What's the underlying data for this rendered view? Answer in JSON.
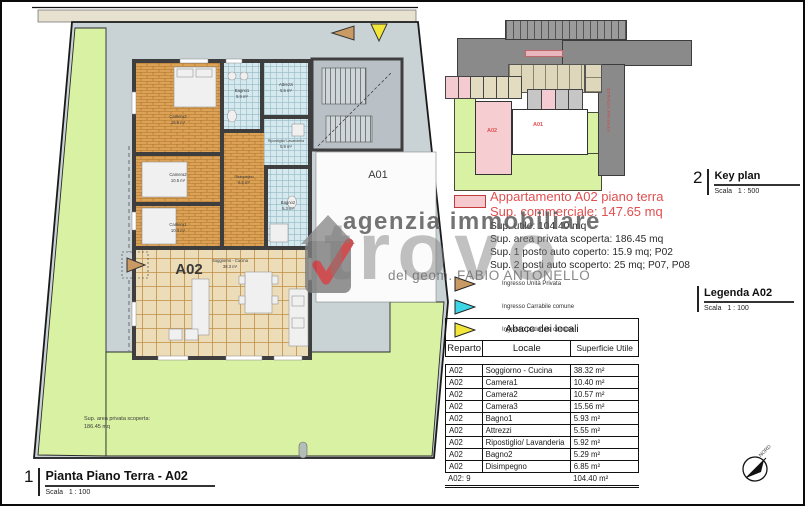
{
  "views": {
    "plan": {
      "number": "1",
      "title": "Pianta Piano Terra - A02",
      "scale": "Scala   1 : 100"
    },
    "keyplan": {
      "number": "2",
      "title": "Key plan",
      "scale": "Scala   1 : 500"
    },
    "legend": {
      "title": "Legenda A02",
      "scale": "Scala   1 : 100"
    }
  },
  "plan": {
    "apartment_label": "A02",
    "neighbor_label": "A01",
    "garden_note": {
      "line1": "Sup. area privata scoperta:",
      "line2": "186.45 mq"
    },
    "rooms": {
      "soggiorno": {
        "name": "Soggiorno - Cucina",
        "area": "38.3 m²"
      },
      "camera1": {
        "name": "Camera1",
        "area": "10.4 m²"
      },
      "camera2": {
        "name": "Camera2",
        "area": "10.5 m²"
      },
      "camera3": {
        "name": "Camera3",
        "area": "15.5 m²"
      },
      "bagno1": {
        "name": "Bagno1",
        "area": "5.9 m²"
      },
      "attrezzi": {
        "name": "Attrezzi",
        "area": "5.5 m²"
      },
      "ripostiglio": {
        "name": "Ripostiglio/ Lavanderia",
        "area": "5.9 m²"
      },
      "bagno2": {
        "name": "Bagno2",
        "area": "5.3 m²"
      },
      "disimpegno": {
        "name": "Disimpegno",
        "area": "6.8 m²"
      }
    }
  },
  "keyplan": {
    "a02_label": "A02",
    "a01_label": "A01",
    "road_label": "STRADA PRIVATA"
  },
  "info": {
    "title": "Appartamento A02 piano terra",
    "subtitle": "Sup. commerciale: 147.65 mq",
    "details": [
      "Sup. utile: 104.40 mq",
      "Sup. area privata scoperta: 186.45 mq",
      "Sup. 1 posto auto coperto: 15.9 mq; P02",
      "Sup. 2 posti auto scoperto: 25 mq; P07, P08"
    ],
    "swatch_color": "#f6c9ce",
    "entrances": [
      {
        "label": "Ingresso Unità Privata",
        "color": "#c99a63"
      },
      {
        "label": "Ingresso Carrabile comune",
        "color": "#3cd6e6"
      },
      {
        "label": "Ingresso pedonale comune",
        "color": "#f2e63a"
      }
    ]
  },
  "table": {
    "title": "Abaco dei locali",
    "headers": [
      "Reparto",
      "Locale",
      "Superficie Utile"
    ],
    "rows": [
      [
        "A02",
        "Soggiorno - Cucina",
        "38.32 m²"
      ],
      [
        "A02",
        "Camera1",
        "10.40 m²"
      ],
      [
        "A02",
        "Camera2",
        "10.57 m²"
      ],
      [
        "A02",
        "Camera3",
        "15.56 m²"
      ],
      [
        "A02",
        "Bagno1",
        "5.93 m²"
      ],
      [
        "A02",
        "Attrezzi",
        "5.55 m²"
      ],
      [
        "A02",
        "Ripostiglio/ Lavanderia",
        "5.92 m²"
      ],
      [
        "A02",
        "Bagno2",
        "5.29 m²"
      ],
      [
        "A02",
        "Disimpegno",
        "6.85 m²"
      ]
    ],
    "total_label": "A02: 9",
    "total_value": "104.40 m²"
  },
  "watermark": {
    "top": "agenzia immobiliare",
    "main": "trovo",
    "byline": "del geom. FABIO ANTONELLO"
  },
  "compass": {
    "label": "NORD"
  },
  "colors": {
    "red_label": "#e05050",
    "garden_green": "#d9f1a3",
    "paving_gray": "#c9d2d5",
    "road_gray": "#8a8a8a",
    "wall_dark": "#3e3e3e"
  }
}
